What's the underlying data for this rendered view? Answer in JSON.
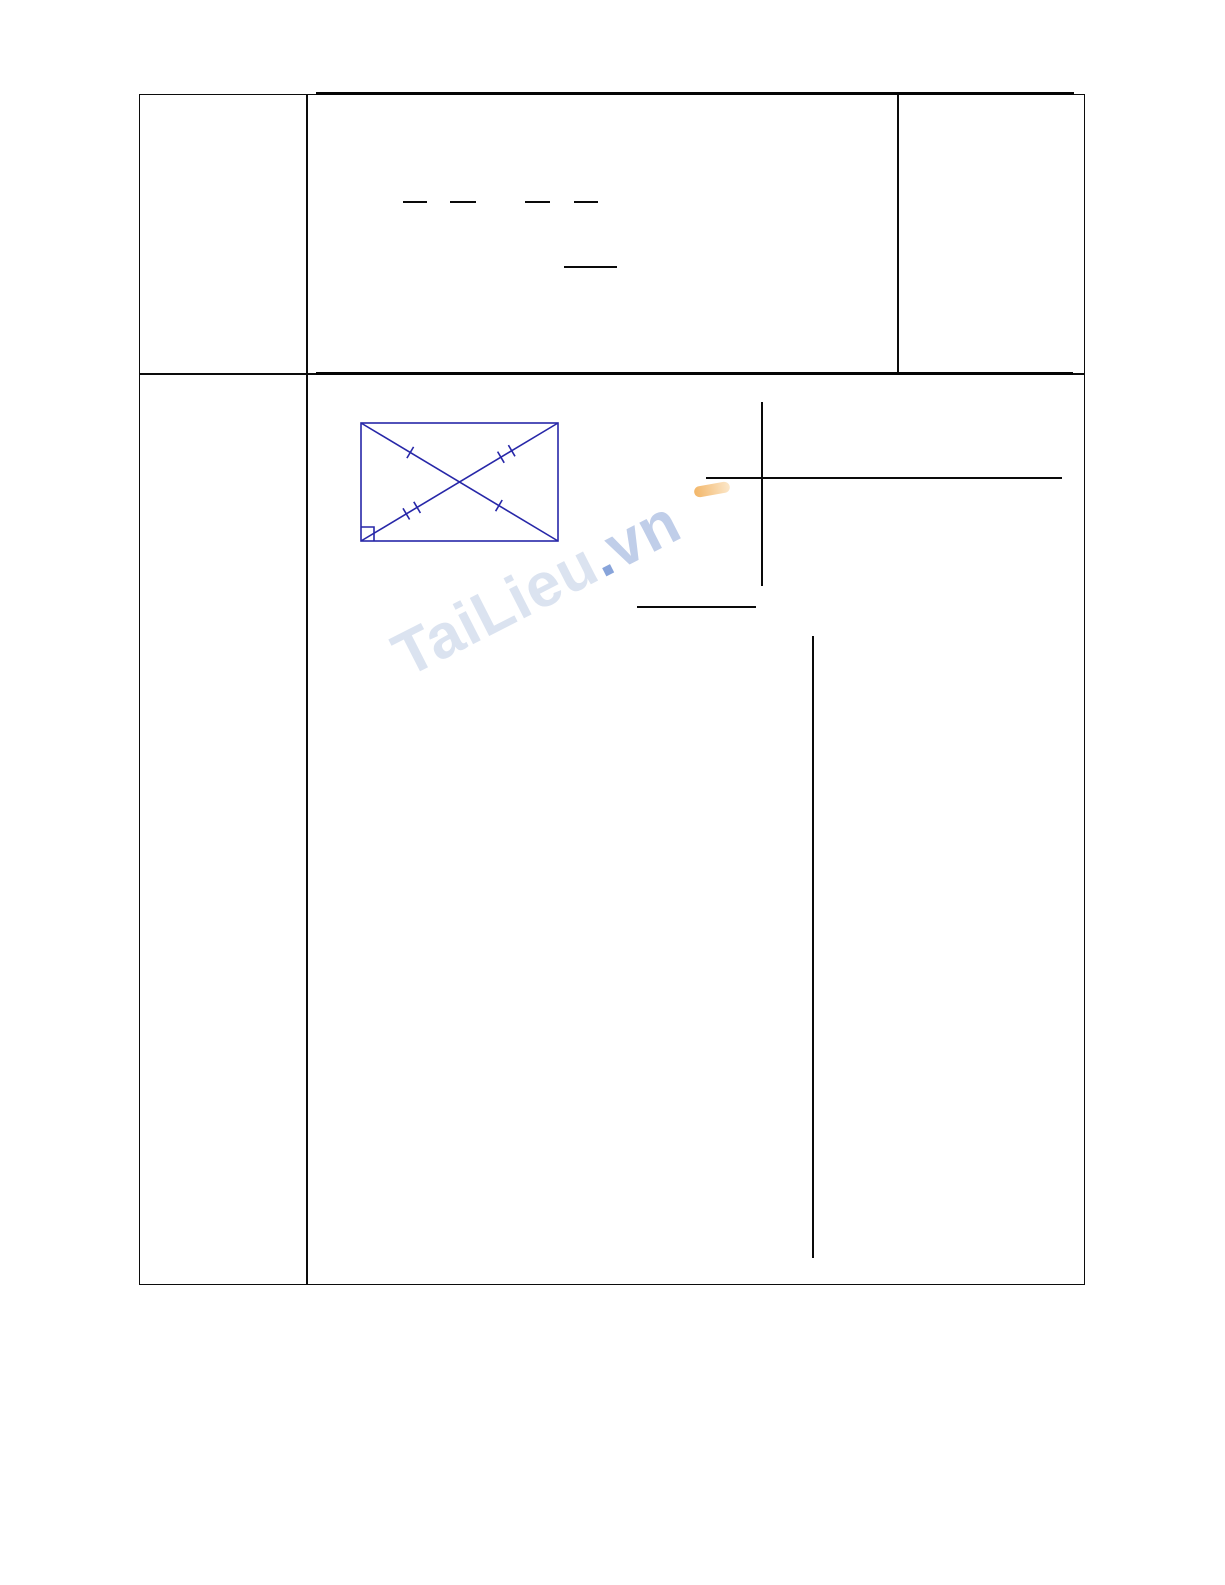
{
  "watermark": {
    "brand": "TaiLieu",
    "dot": ".",
    "tld": "vn",
    "color_brand": "#dbe3f0",
    "color_dot": "#88a4da",
    "color_tld": "#c0cee9",
    "accent_orange": "#f0a94e"
  },
  "figure": {
    "name": "rectangle-with-diagonals",
    "stroke_color": "#2727a8",
    "marks": [
      "single-tick",
      "double-tick",
      "right-angle-square"
    ]
  },
  "rules": {
    "border_color": "#0c0c0c",
    "heavy_rule_color": "#050505",
    "content_line_color": "#0a0a0a"
  }
}
